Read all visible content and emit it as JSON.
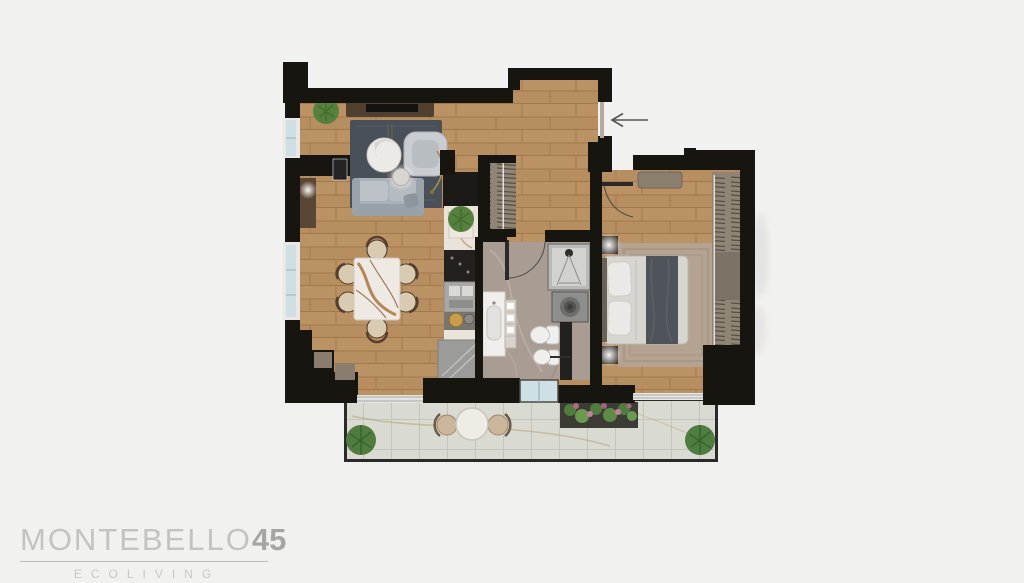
{
  "brand": {
    "name": "MONTEBELLO",
    "number": "45",
    "tagline": "ECOLIVING"
  },
  "floor_plan": {
    "entry": {
      "arrow_direction": "left",
      "arrow_meaning": "entrance"
    },
    "rooms": [
      {
        "name": "living-room",
        "floor": "wood"
      },
      {
        "name": "dining-area",
        "floor": "wood"
      },
      {
        "name": "kitchen-strip",
        "floor": "wood"
      },
      {
        "name": "hallway",
        "floor": "wood"
      },
      {
        "name": "entry-closet",
        "floor": "wood"
      },
      {
        "name": "bathroom",
        "floor": "marble"
      },
      {
        "name": "bedroom",
        "floor": "wood"
      },
      {
        "name": "balcony",
        "floor": "tile"
      }
    ],
    "furniture": [
      "tv-console",
      "tv",
      "area-rug",
      "sofa",
      "lounge-chair",
      "armchair",
      "coffee-table",
      "arc-lamp",
      "side-console",
      "dining-table",
      "dining-chairs-x6",
      "potted-plants",
      "kitchen-tall-units",
      "kitchen-sink",
      "cooktop",
      "kitchen-island",
      "closet-hangers",
      "bathroom-vanity",
      "shelf-niche",
      "shower",
      "washing-machine",
      "toilet",
      "bidet",
      "double-bed",
      "pillows",
      "throw-blanket",
      "nightstands",
      "bedside-lamps",
      "bedroom-rug",
      "wardrobe",
      "bedroom-bench",
      "balcony-table",
      "balcony-chairs-x2",
      "flower-planter",
      "bushes"
    ]
  },
  "palette": {
    "background": "#f1f1f0",
    "walls": "#17150f",
    "wood_floor": "#bb9264",
    "bathroom_marble": "#a89c93",
    "balcony_tile": "#d9dad2",
    "glass": "#cfe0e4",
    "sofa_gray": "#a9b1b8",
    "rug_dark": "#4a5057",
    "bed_linen": "#d7d5d0",
    "throw_dark": "#4f535a",
    "wardrobe_taupe": "#8f8577",
    "plant_green": "#55813e",
    "flower_pink": "#b0688a",
    "logo_gray": "#c3c3c3"
  }
}
